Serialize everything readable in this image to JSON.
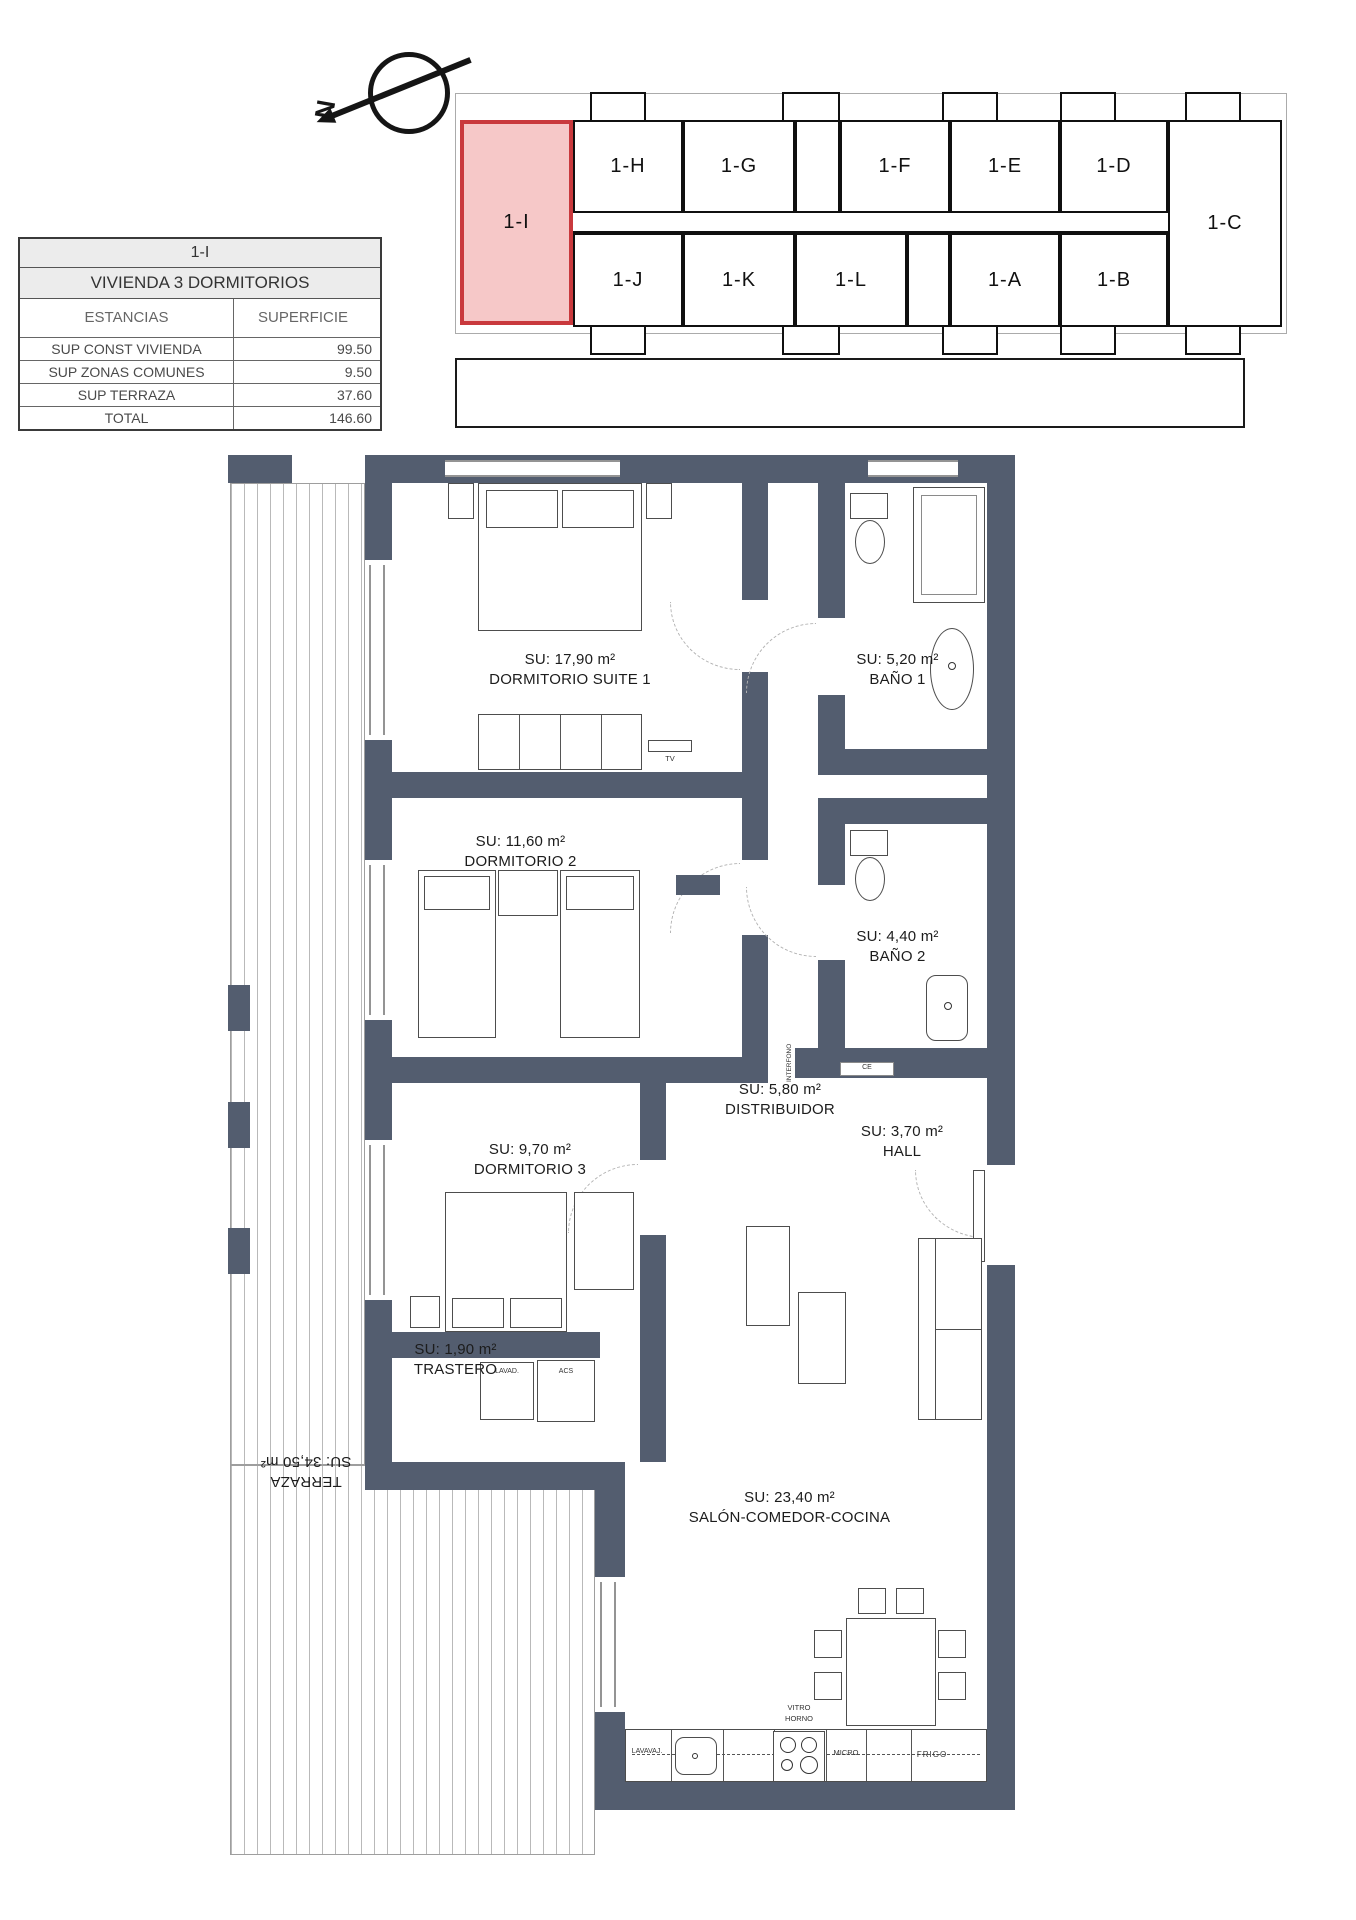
{
  "north": {
    "letter": "N"
  },
  "info_table": {
    "unit": "1-I",
    "type": "VIVIENDA 3 DORMITORIOS",
    "col_rooms": "ESTANCIAS",
    "col_area": "SUPERFICIE",
    "rows": [
      {
        "label": "SUP CONST VIVIENDA",
        "value": "99.50"
      },
      {
        "label": "SUP ZONAS COMUNES",
        "value": "9.50"
      },
      {
        "label": "SUP TERRAZA",
        "value": "37.60"
      },
      {
        "label": "TOTAL",
        "value": "146.60"
      }
    ]
  },
  "key_plan": {
    "highlighted": "1-I",
    "highlight_fill": "#f6c8c8",
    "highlight_border": "#c9393d",
    "top_row": [
      "1-H",
      "1-G",
      "1-F",
      "1-E",
      "1-D"
    ],
    "bottom_row": [
      "1-J",
      "1-K",
      "1-L",
      "1-A",
      "1-B"
    ],
    "right": "1-C"
  },
  "plan": {
    "wall_color": "#535d6f",
    "rooms": [
      {
        "area": "SU: 17,90 m²",
        "name": "DORMITORIO SUITE 1"
      },
      {
        "area": "SU: 5,20 m²",
        "name": "BAÑO 1"
      },
      {
        "area": "SU: 11,60 m²",
        "name": "DORMITORIO 2"
      },
      {
        "area": "SU: 4,40 m²",
        "name": "BAÑO 2"
      },
      {
        "area": "SU: 5,80 m²",
        "name": "DISTRIBUIDOR"
      },
      {
        "area": "SU: 3,70 m²",
        "name": "HALL"
      },
      {
        "area": "SU: 9,70 m²",
        "name": "DORMITORIO 3"
      },
      {
        "area": "SU: 1,90 m²",
        "name": "TRASTERO"
      },
      {
        "area": "SU: 23,40 m²",
        "name": "SALÓN-COMEDOR-COCINA"
      },
      {
        "area": "SU: 34,50 m²",
        "name": "TERRAZA"
      }
    ],
    "labels": {
      "tv": "TV",
      "lavad": "LAVAD.",
      "acs": "ACS",
      "interfono": "INTERFONO",
      "ce": "CE",
      "lavavaj": "LAVAVAJ.",
      "vitro": "VITRO",
      "horno": "HORNO",
      "micro": "MICRO",
      "frigo": "FRIGO"
    }
  }
}
